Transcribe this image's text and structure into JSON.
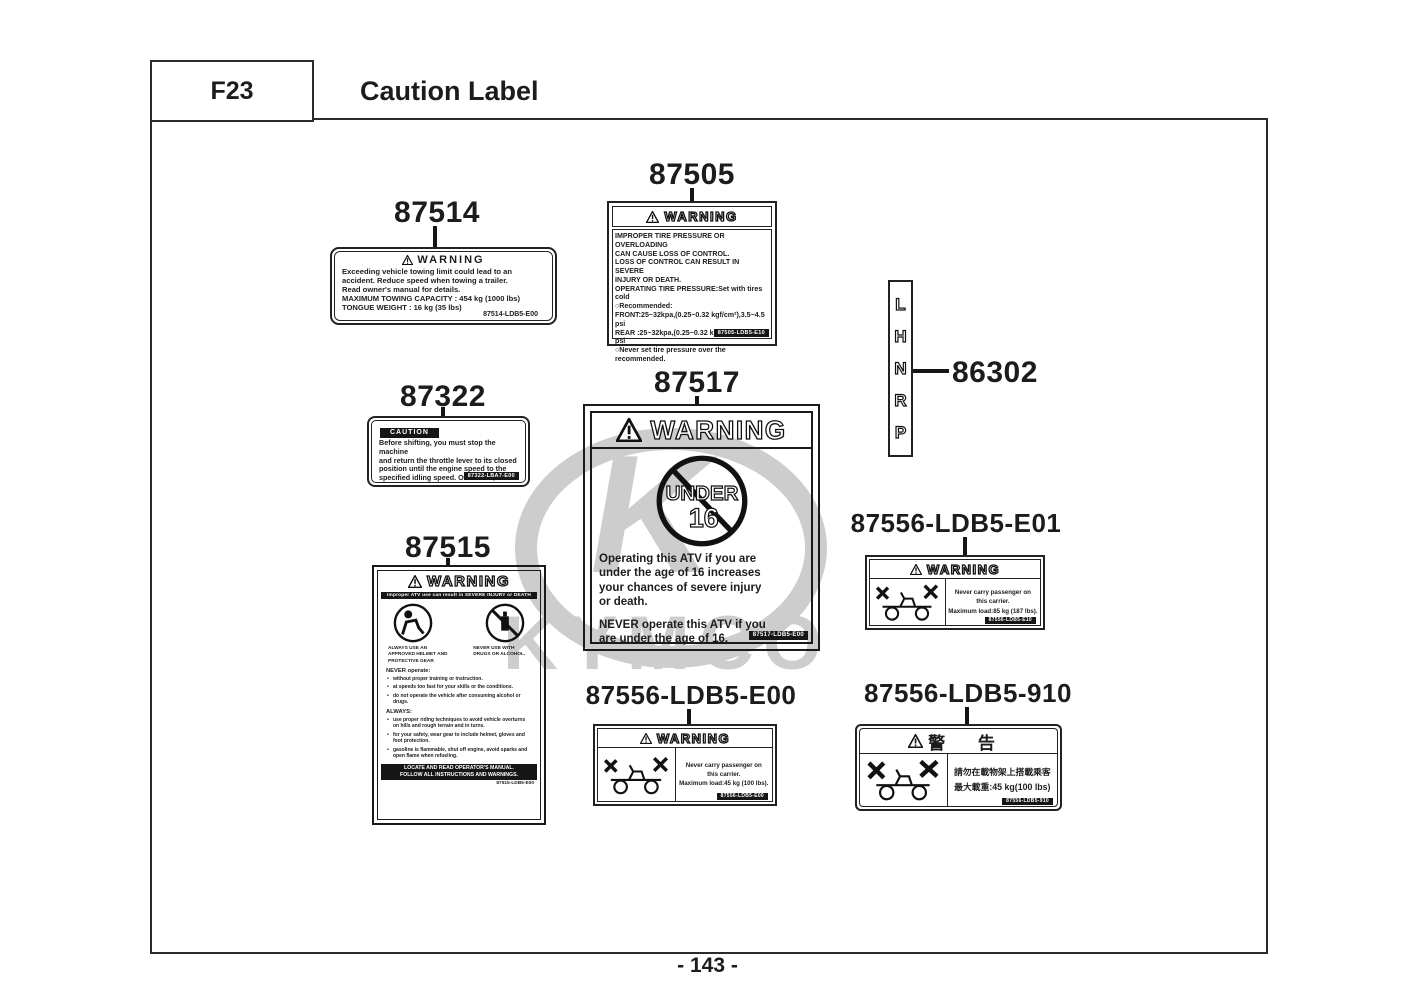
{
  "header": {
    "section_code": "F23",
    "title": "Caution Label"
  },
  "page_number": "- 143 -",
  "watermark": {
    "logo_letter": "K",
    "brand": "KYMCO"
  },
  "labels": {
    "l87514": {
      "part_number": "87514",
      "header": "WARNING",
      "body": "Exceeding vehicle towing limit could lead to an\naccident. Reduce speed when towing a trailer.\nRead owner's manual for details.\nMAXIMUM TOWING CAPACITY : 454 kg (1000 lbs)\nTONGUE WEIGHT : 16 kg (35 lbs)",
      "code": "87514-LDB5-E00"
    },
    "l87505": {
      "part_number": "87505",
      "header": "WARNING",
      "body": "IMPROPER TIRE PRESSURE OR OVERLOADING\nCAN CAUSE LOSS OF CONTROL.\nLOSS OF CONTROL CAN RESULT IN SEVERE\nINJURY OR DEATH.\nOPERATING TIRE PRESSURE:Set with tires cold\n○Recommended:\nFRONT:25~32kpa,(0.25~0.32 kgf/cm²),3.5~4.5 psi\nREAR :25~32kpa,(0.25~0.32 kgf/cm²),3.5~4.5 psi\n○Never set tire pressure over the recommended.",
      "code": "87505-LDB5-E10"
    },
    "l87322": {
      "part_number": "87322",
      "header": "CAUTION",
      "body": "Before shifting, you must stop the machine\nand return the throttle lever to its closed\nposition until the engine speed to the\nspecified idling speed. Otherwise, the\ntransmission may be damaged.",
      "code": "87322-LBA7-E00"
    },
    "l87517": {
      "part_number": "87517",
      "header": "WARNING",
      "picto_line1": "UNDER",
      "picto_line2": "16",
      "para1": "Operating this ATV if you are\nunder the age of 16 increases\nyour chances of severe injury\nor death.",
      "para2": "NEVER operate this ATV if you\nare under the age of 16.",
      "code": "87517-LDB5-E00"
    },
    "l86302": {
      "part_number": "86302",
      "letters": [
        "L",
        "H",
        "N",
        "R",
        "P"
      ]
    },
    "l87515": {
      "part_number": "87515",
      "header": "WARNING",
      "subheader": "Improper ATV use can result in SEVERE INJURY or DEATH",
      "caption_left": "ALWAYS USE AN APPROVED HELMET AND PROTECTIVE GEAR",
      "caption_right": "NEVER USE WITH DRUGS OR ALCOHOL.",
      "never_title": "NEVER operate:",
      "never_items": [
        "without proper training or instruction.",
        "at speeds too fast for your skills or the conditions.",
        "do not operate the vehicle after consuming alcohol or drugs."
      ],
      "always_title": "ALWAYS:",
      "always_items": [
        "use proper riding techniques to avoid vehicle overturns on hills and rough terrain and in turns.",
        "for your safety, wear gear to include helmet, gloves and foot protection.",
        "gasoline is flammable, shut off engine, avoid sparks and open flame when refueling."
      ],
      "footer": "LOCATE AND READ OPERATOR'S MANUAL.\nFOLLOW ALL INSTRUCTIONS AND WARNINGS.",
      "code": "87515-LDB5-E00"
    },
    "l87556_e01": {
      "part_number": "87556-LDB5-E01",
      "header": "WARNING",
      "text": "Never carry passenger on\nthis carrier.\nMaximum load:85 kg (187 lbs).",
      "code": "87556-LDB5-E10"
    },
    "l87556_e00": {
      "part_number": "87556-LDB5-E00",
      "header": "WARNING",
      "text": "Never carry passenger on\nthis carrier.\nMaximum load:45 kg (100 lbs).",
      "code": "87556-LDB5-E00"
    },
    "l87556_910": {
      "part_number": "87556-LDB5-910",
      "header": "警 告",
      "text": "請勿在載物架上搭載乘客\n最大載重:45 kg(100 lbs)",
      "code": "87556-LDB5-910"
    }
  }
}
